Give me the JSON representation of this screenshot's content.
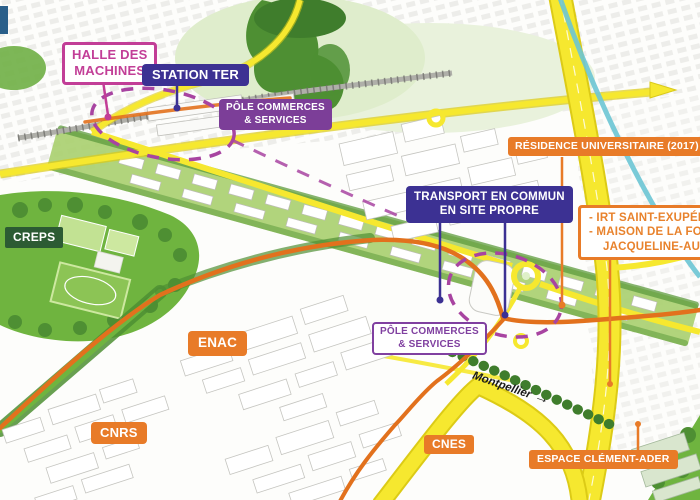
{
  "labels": {
    "halle_des_machines": {
      "lines": [
        "HALLE DES",
        "MACHINES"
      ]
    },
    "station_ter": {
      "text": "STATION TER"
    },
    "pole_commerces_top": {
      "lines": [
        "PÔLE COMMERCES",
        "& SERVICES"
      ]
    },
    "transport_commun": {
      "lines": [
        "TRANSPORT EN COMMUN",
        "EN SITE PROPRE"
      ]
    },
    "residence_universitaire": {
      "text": "RÉSIDENCE UNIVERSITAIRE (2017)"
    },
    "irt_maison": {
      "lines": [
        "- IRT SAINT-EXUPÉRY",
        "- MAISON DE LA FORMATION",
        "JACQUELINE-AURIOL"
      ]
    },
    "creps": {
      "text": "CREPS"
    },
    "enac": {
      "text": "ENAC"
    },
    "pole_commerces_bottom": {
      "lines": [
        "PÔLE COMMERCES",
        "& SERVICES"
      ]
    },
    "cnrs": {
      "text": "CNRS"
    },
    "cnes": {
      "text": "CNES"
    },
    "espace_clement_ader": {
      "text": "ESPACE CLÉMENT-ADER"
    },
    "montpellier": {
      "text": "Montpellier",
      "arrow": "→"
    }
  },
  "colors": {
    "magenta": "#C23E97",
    "indigo": "#3C3193",
    "purple_dash": "#A844A1",
    "orange": "#E87B28",
    "route_orange": "#E2711D",
    "road_yellow": "#F6E82F",
    "road_yellow_edge": "#DCCB16",
    "canal_teal": "#6CC5D4",
    "park_green": "#6FB43F",
    "tree_green": "#4E8F33",
    "dark_green": "#2C5B33"
  }
}
